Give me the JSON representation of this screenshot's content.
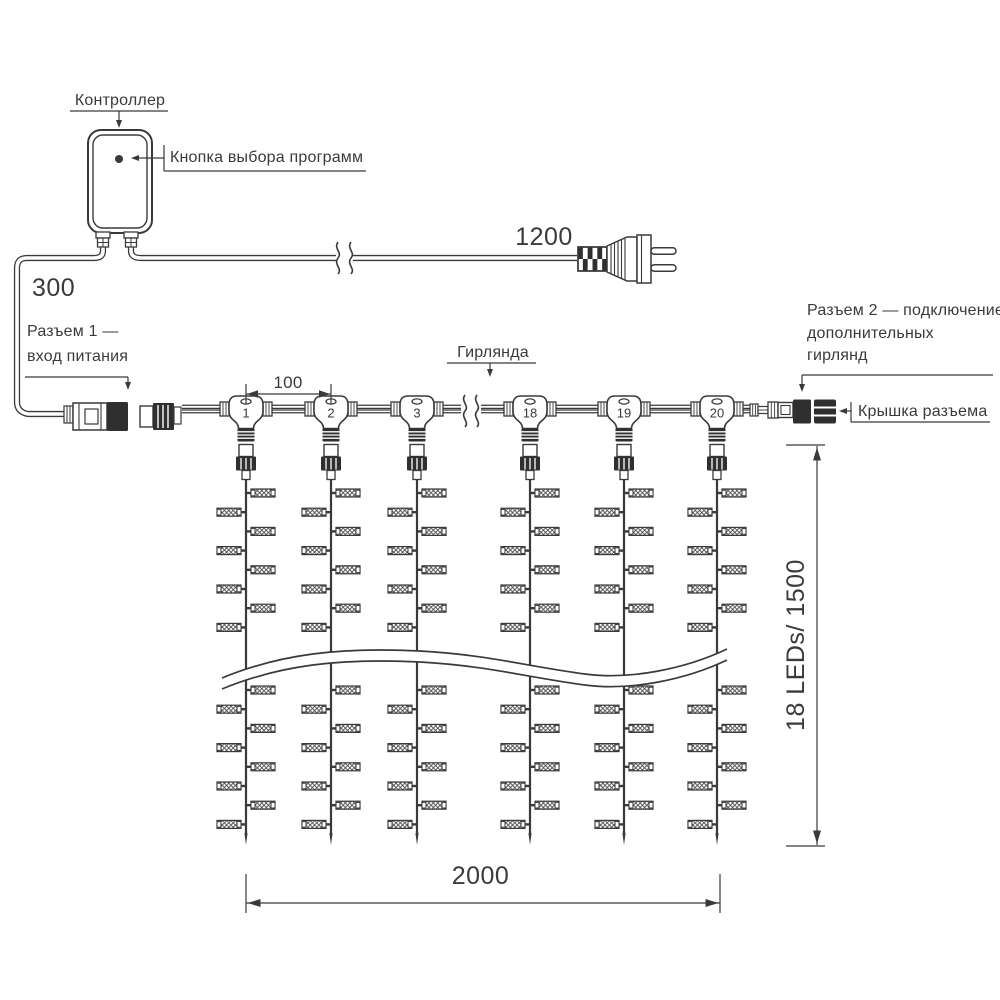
{
  "labels": {
    "controller": "Контроллер",
    "program_button": "Кнопка выбора программ",
    "power_cable_length": "1200",
    "input_lead_length": "300",
    "connector1": [
      "Разъем 1 —",
      "вход питания"
    ],
    "garland": "Гирлянда",
    "connector2": [
      "Разъем 2 — подключение",
      "дополнительных",
      "гирлянд"
    ],
    "connector_cap": "Крышка разъема",
    "drop_spacing": "100",
    "curtain_width": "2000",
    "curtain_height": "18 LEDs/ 1500"
  },
  "diagram": {
    "line_color": "#3a3a3a",
    "dark_fill": "#2f2f2f",
    "drops": [
      {
        "number": "1",
        "x": 246
      },
      {
        "number": "2",
        "x": 331
      },
      {
        "number": "3",
        "x": 417
      },
      {
        "number": "18",
        "x": 530
      },
      {
        "number": "19",
        "x": 624
      },
      {
        "number": "20",
        "x": 717
      }
    ],
    "led_rows_above": {
      "start_y": 493,
      "step": 19.2,
      "count": 8
    },
    "led_rows_below": {
      "start_y": 690,
      "step": 19.2,
      "count": 8
    },
    "string_top_y": 480,
    "string_line_end_y": 833,
    "string_tip_y": 845,
    "main_cable": {
      "x1": 182,
      "x2": 750,
      "y_top": 405,
      "y_bot": 413,
      "break_x": 471
    },
    "power_cable": {
      "y": 258,
      "break_x": 344
    },
    "wave": {
      "x1": 222,
      "x2": 727
    },
    "dims": {
      "spacing": {
        "x1": 246,
        "x2": 331,
        "line_y": 394
      },
      "width": {
        "x1": 246,
        "x2": 720,
        "line_y": 903
      },
      "height": {
        "x": 817,
        "y1": 446,
        "y2": 846
      }
    }
  }
}
